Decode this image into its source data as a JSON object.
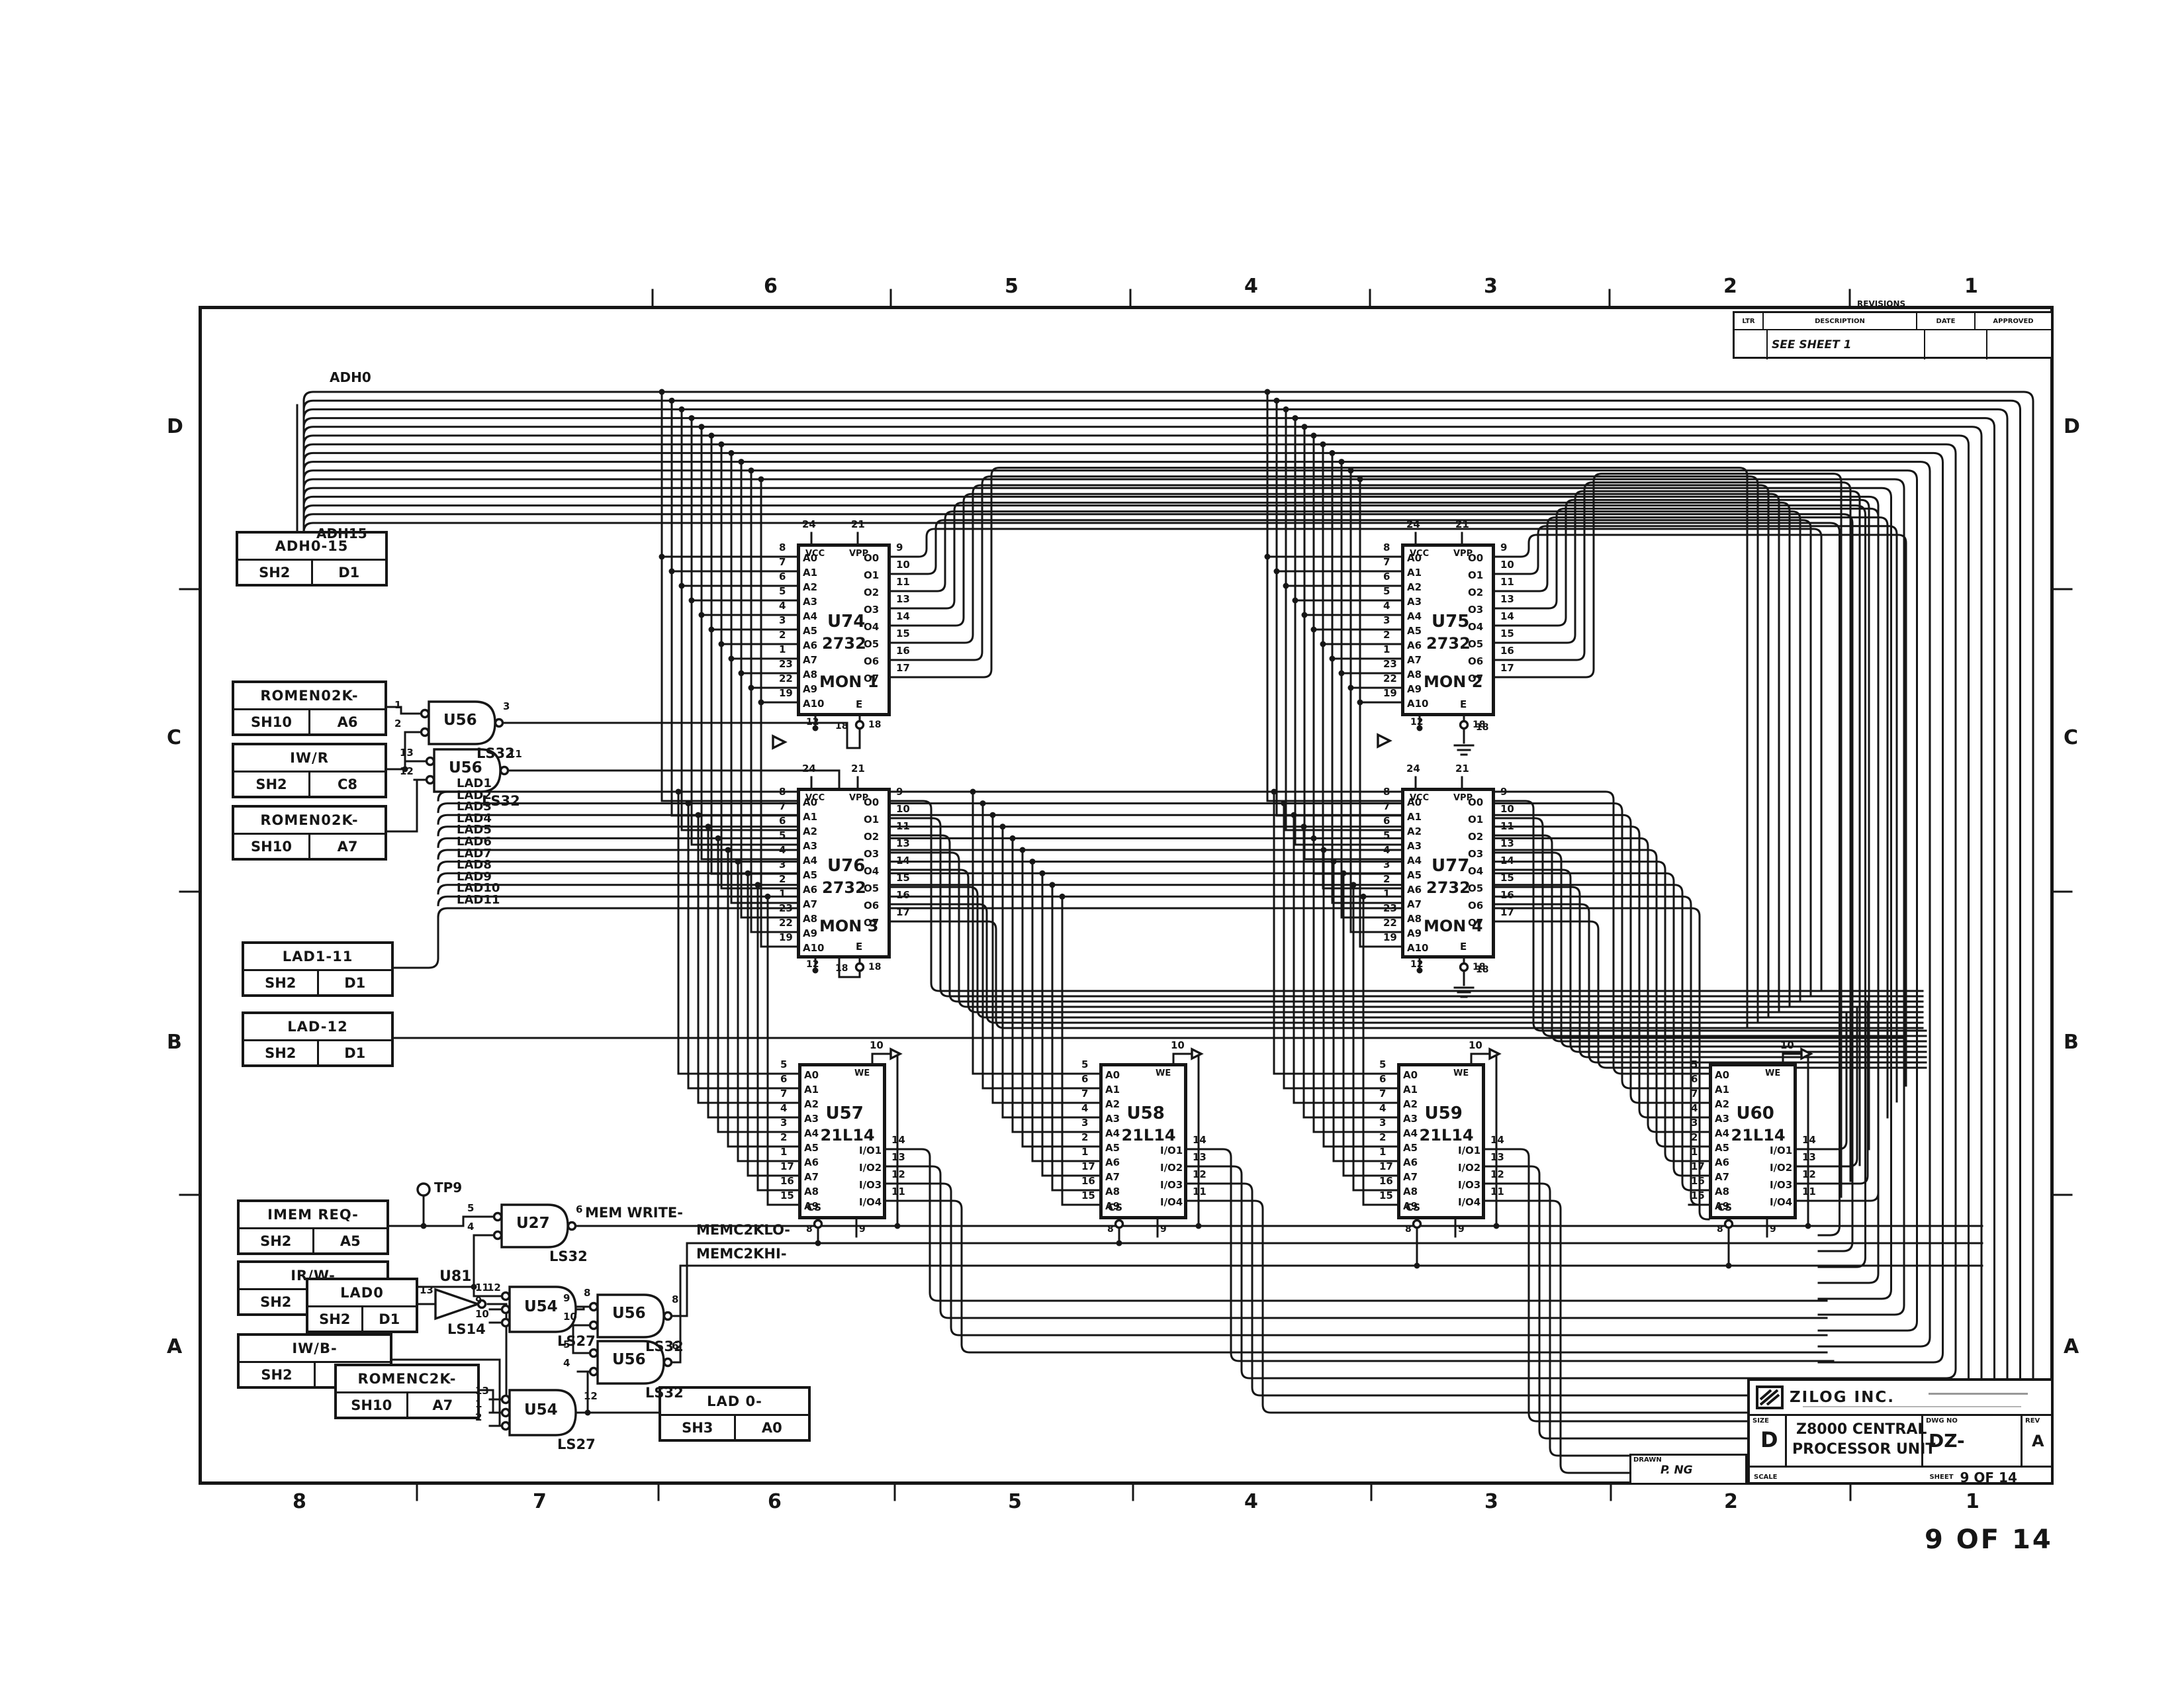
{
  "sheet": {
    "page_label": "9 OF 14",
    "zones_top": [
      "6",
      "5",
      "4",
      "3",
      "2",
      "1"
    ],
    "zones_bottom": [
      "8",
      "7",
      "6",
      "5",
      "4",
      "3",
      "2",
      "1"
    ],
    "rows_left": [
      "D",
      "C",
      "B",
      "A"
    ],
    "rows_right": [
      "D",
      "C",
      "B",
      "A"
    ]
  },
  "revisions": {
    "title": "REVISIONS",
    "columns": [
      "LTR",
      "DESCRIPTION",
      "DATE",
      "APPROVED"
    ],
    "entry": "SEE SHEET 1"
  },
  "title_block": {
    "company": "ZILOG INC.",
    "size_label": "SIZE",
    "size": "D",
    "title_line1": "Z8000 CENTRAL",
    "title_line2": "PROCESSOR UNIT",
    "dwg_label": "DWG NO",
    "dwg_no": "DZ-",
    "rev_label": "REV",
    "rev": "A",
    "scale_label": "SCALE",
    "sheet_label": "SHEET",
    "sheet": "9 OF 14",
    "drawn_label": "DRAWN",
    "drawn": "P. NG"
  },
  "connectors": [
    {
      "id": "adh",
      "signal": "ADH0-15",
      "sheet": "SH2",
      "zone": "D1"
    },
    {
      "id": "romen_a6",
      "signal": "ROMEN02K-",
      "sheet": "SH10",
      "zone": "A6"
    },
    {
      "id": "iwr",
      "signal": "IW/R",
      "sheet": "SH2",
      "zone": "C8"
    },
    {
      "id": "romen_a7",
      "signal": "ROMEN02K-",
      "sheet": "SH10",
      "zone": "A7"
    },
    {
      "id": "lad1_11",
      "signal": "LAD1-11",
      "sheet": "SH2",
      "zone": "D1"
    },
    {
      "id": "lad12",
      "signal": "LAD-12",
      "sheet": "SH2",
      "zone": "D1"
    },
    {
      "id": "memreq",
      "signal": "IMEM REQ-",
      "sheet": "SH2",
      "zone": "A5"
    },
    {
      "id": "irw",
      "signal": "IR/W-",
      "sheet": "SH2",
      "zone": "C8"
    },
    {
      "id": "lad0",
      "signal": "LAD0",
      "sheet": "SH2",
      "zone": "D1"
    },
    {
      "id": "iwb",
      "signal": "IW/B-",
      "sheet": "SH2",
      "zone": "C7"
    },
    {
      "id": "romenc",
      "signal": "ROMENC2K-",
      "sheet": "SH10",
      "zone": "A7"
    },
    {
      "id": "lad0out",
      "signal": "LAD 0-",
      "sheet": "SH3",
      "zone": "A0"
    }
  ],
  "chips": [
    {
      "id": "U74",
      "ref": "U74",
      "part": "2732",
      "name": "MON 1",
      "left": [
        [
          "8",
          "A0"
        ],
        [
          "7",
          "A1"
        ],
        [
          "6",
          "A2"
        ],
        [
          "5",
          "A3"
        ],
        [
          "4",
          "A4"
        ],
        [
          "3",
          "A5"
        ],
        [
          "2",
          "A6"
        ],
        [
          "1",
          "A7"
        ],
        [
          "23",
          "A8"
        ],
        [
          "22",
          "A9"
        ],
        [
          "19",
          "A10"
        ]
      ],
      "right": [
        [
          "9",
          "O0"
        ],
        [
          "10",
          "O1"
        ],
        [
          "11",
          "O2"
        ],
        [
          "13",
          "O3"
        ],
        [
          "14",
          "O4"
        ],
        [
          "15",
          "O5"
        ],
        [
          "16",
          "O6"
        ],
        [
          "17",
          "O7"
        ]
      ],
      "top": [
        [
          "24",
          "VCC"
        ],
        [
          "21",
          "VPP"
        ]
      ],
      "bottom": [
        [
          "12",
          ""
        ],
        [
          "18",
          "E"
        ]
      ]
    },
    {
      "id": "U75",
      "ref": "U75",
      "part": "2732",
      "name": "MON 2",
      "left": [
        [
          "8",
          "A0"
        ],
        [
          "7",
          "A1"
        ],
        [
          "6",
          "A2"
        ],
        [
          "5",
          "A3"
        ],
        [
          "4",
          "A4"
        ],
        [
          "3",
          "A5"
        ],
        [
          "2",
          "A6"
        ],
        [
          "1",
          "A7"
        ],
        [
          "23",
          "A8"
        ],
        [
          "22",
          "A9"
        ],
        [
          "19",
          "A10"
        ]
      ],
      "right": [
        [
          "9",
          "O0"
        ],
        [
          "10",
          "O1"
        ],
        [
          "11",
          "O2"
        ],
        [
          "13",
          "O3"
        ],
        [
          "14",
          "O4"
        ],
        [
          "15",
          "O5"
        ],
        [
          "16",
          "O6"
        ],
        [
          "17",
          "O7"
        ]
      ],
      "top": [
        [
          "24",
          "VCC"
        ],
        [
          "21",
          "VPP"
        ]
      ],
      "bottom": [
        [
          "12",
          ""
        ],
        [
          "18",
          "E"
        ]
      ]
    },
    {
      "id": "U76",
      "ref": "U76",
      "part": "2732",
      "name": "MON 3",
      "left": [
        [
          "8",
          "A0"
        ],
        [
          "7",
          "A1"
        ],
        [
          "6",
          "A2"
        ],
        [
          "5",
          "A3"
        ],
        [
          "4",
          "A4"
        ],
        [
          "3",
          "A5"
        ],
        [
          "2",
          "A6"
        ],
        [
          "1",
          "A7"
        ],
        [
          "23",
          "A8"
        ],
        [
          "22",
          "A9"
        ],
        [
          "19",
          "A10"
        ]
      ],
      "right": [
        [
          "9",
          "O0"
        ],
        [
          "10",
          "O1"
        ],
        [
          "11",
          "O2"
        ],
        [
          "13",
          "O3"
        ],
        [
          "14",
          "O4"
        ],
        [
          "15",
          "O5"
        ],
        [
          "16",
          "O6"
        ],
        [
          "17",
          "O7"
        ]
      ],
      "top": [
        [
          "24",
          "VCC"
        ],
        [
          "21",
          "VPP"
        ]
      ],
      "bottom": [
        [
          "12",
          ""
        ],
        [
          "18",
          "E"
        ]
      ]
    },
    {
      "id": "U77",
      "ref": "U77",
      "part": "2732",
      "name": "MON 4",
      "left": [
        [
          "8",
          "A0"
        ],
        [
          "7",
          "A1"
        ],
        [
          "6",
          "A2"
        ],
        [
          "5",
          "A3"
        ],
        [
          "4",
          "A4"
        ],
        [
          "3",
          "A5"
        ],
        [
          "2",
          "A6"
        ],
        [
          "1",
          "A7"
        ],
        [
          "23",
          "A8"
        ],
        [
          "22",
          "A9"
        ],
        [
          "19",
          "A10"
        ]
      ],
      "right": [
        [
          "9",
          "O0"
        ],
        [
          "10",
          "O1"
        ],
        [
          "11",
          "O2"
        ],
        [
          "13",
          "O3"
        ],
        [
          "14",
          "O4"
        ],
        [
          "15",
          "O5"
        ],
        [
          "16",
          "O6"
        ],
        [
          "17",
          "O7"
        ]
      ],
      "top": [
        [
          "24",
          "VCC"
        ],
        [
          "21",
          "VPP"
        ]
      ],
      "bottom": [
        [
          "12",
          ""
        ],
        [
          "18",
          "E"
        ]
      ]
    },
    {
      "id": "U57",
      "ref": "U57",
      "part": "21L14",
      "name": "",
      "left": [
        [
          "5",
          "A0"
        ],
        [
          "6",
          "A1"
        ],
        [
          "7",
          "A2"
        ],
        [
          "4",
          "A3"
        ],
        [
          "3",
          "A4"
        ],
        [
          "2",
          "A5"
        ],
        [
          "1",
          "A6"
        ],
        [
          "17",
          "A7"
        ],
        [
          "16",
          "A8"
        ],
        [
          "15",
          "A9"
        ]
      ],
      "right": [
        [
          "14",
          "I/O1"
        ],
        [
          "13",
          "I/O2"
        ],
        [
          "12",
          "I/O3"
        ],
        [
          "11",
          "I/O4"
        ]
      ],
      "top": [
        [
          "10",
          "WE"
        ]
      ],
      "bottom": [
        [
          "8",
          "CS"
        ],
        [
          "9",
          ""
        ]
      ]
    },
    {
      "id": "U58",
      "ref": "U58",
      "part": "21L14",
      "name": "",
      "left": [
        [
          "5",
          "A0"
        ],
        [
          "6",
          "A1"
        ],
        [
          "7",
          "A2"
        ],
        [
          "4",
          "A3"
        ],
        [
          "3",
          "A4"
        ],
        [
          "2",
          "A5"
        ],
        [
          "1",
          "A6"
        ],
        [
          "17",
          "A7"
        ],
        [
          "16",
          "A8"
        ],
        [
          "15",
          "A9"
        ]
      ],
      "right": [
        [
          "14",
          "I/O1"
        ],
        [
          "13",
          "I/O2"
        ],
        [
          "12",
          "I/O3"
        ],
        [
          "11",
          "I/O4"
        ]
      ],
      "top": [
        [
          "10",
          "WE"
        ]
      ],
      "bottom": [
        [
          "8",
          "CS"
        ],
        [
          "9",
          ""
        ]
      ]
    },
    {
      "id": "U59",
      "ref": "U59",
      "part": "21L14",
      "name": "",
      "left": [
        [
          "5",
          "A0"
        ],
        [
          "6",
          "A1"
        ],
        [
          "7",
          "A2"
        ],
        [
          "4",
          "A3"
        ],
        [
          "3",
          "A4"
        ],
        [
          "2",
          "A5"
        ],
        [
          "1",
          "A6"
        ],
        [
          "17",
          "A7"
        ],
        [
          "16",
          "A8"
        ],
        [
          "15",
          "A9"
        ]
      ],
      "right": [
        [
          "14",
          "I/O1"
        ],
        [
          "13",
          "I/O2"
        ],
        [
          "12",
          "I/O3"
        ],
        [
          "11",
          "I/O4"
        ]
      ],
      "top": [
        [
          "10",
          "WE"
        ]
      ],
      "bottom": [
        [
          "8",
          "CS"
        ],
        [
          "9",
          ""
        ]
      ]
    },
    {
      "id": "U60",
      "ref": "U60",
      "part": "21L14",
      "name": "",
      "left": [
        [
          "5",
          "A0"
        ],
        [
          "6",
          "A1"
        ],
        [
          "7",
          "A2"
        ],
        [
          "4",
          "A3"
        ],
        [
          "3",
          "A4"
        ],
        [
          "2",
          "A5"
        ],
        [
          "1",
          "A6"
        ],
        [
          "17",
          "A7"
        ],
        [
          "16",
          "A8"
        ],
        [
          "15",
          "A9"
        ]
      ],
      "right": [
        [
          "14",
          "I/O1"
        ],
        [
          "13",
          "I/O2"
        ],
        [
          "12",
          "I/O3"
        ],
        [
          "11",
          "I/O4"
        ]
      ],
      "top": [
        [
          "10",
          "WE"
        ]
      ],
      "bottom": [
        [
          "8",
          "CS"
        ],
        [
          "9",
          ""
        ]
      ]
    }
  ],
  "gates": [
    {
      "id": "U56a",
      "ref": "U56",
      "part": "LS32",
      "pins_in": [
        "1",
        "2"
      ],
      "pin_out": "3"
    },
    {
      "id": "U56b",
      "ref": "U56",
      "part": "LS32",
      "pins_in": [
        "13",
        "12"
      ],
      "pin_out": "11"
    },
    {
      "id": "U27",
      "ref": "U27",
      "part": "LS32",
      "pins_in": [
        "5",
        "4"
      ],
      "pin_out": "6"
    },
    {
      "id": "U81",
      "ref": "U81",
      "part": "LS14",
      "pins_in": [
        "13"
      ],
      "pin_out": "12"
    },
    {
      "id": "U54a",
      "ref": "U54",
      "part": "LS27",
      "pins_in": [
        "11",
        "9",
        "10"
      ],
      "pin_out": "8"
    },
    {
      "id": "U56c",
      "ref": "U56",
      "part": "LS32",
      "pins_in": [
        "9",
        "10"
      ],
      "pin_out": "8"
    },
    {
      "id": "U56d",
      "ref": "U56",
      "part": "LS32",
      "pins_in": [
        "5",
        "4"
      ],
      "pin_out": "6"
    },
    {
      "id": "U54b",
      "ref": "U54",
      "part": "LS27",
      "pins_in": [
        "13",
        "1",
        "2"
      ],
      "pin_out": "12"
    }
  ],
  "wire_labels": {
    "adh0": "ADH0",
    "adh15": "ADH15",
    "lad": [
      "LAD1",
      "LAD2",
      "LAD3",
      "LAD4",
      "LAD5",
      "LAD6",
      "LAD7",
      "LAD8",
      "LAD9",
      "LAD10",
      "LAD11"
    ],
    "mem_write": "MEM WRITE-",
    "memc2klo": "MEMC2KLO-",
    "memc2khi": "MEMC2KHI-",
    "tp9": "TP9",
    "rom_gnd_pin": "18"
  },
  "colors": {
    "ink": "#161616",
    "paper": "#ffffff"
  }
}
